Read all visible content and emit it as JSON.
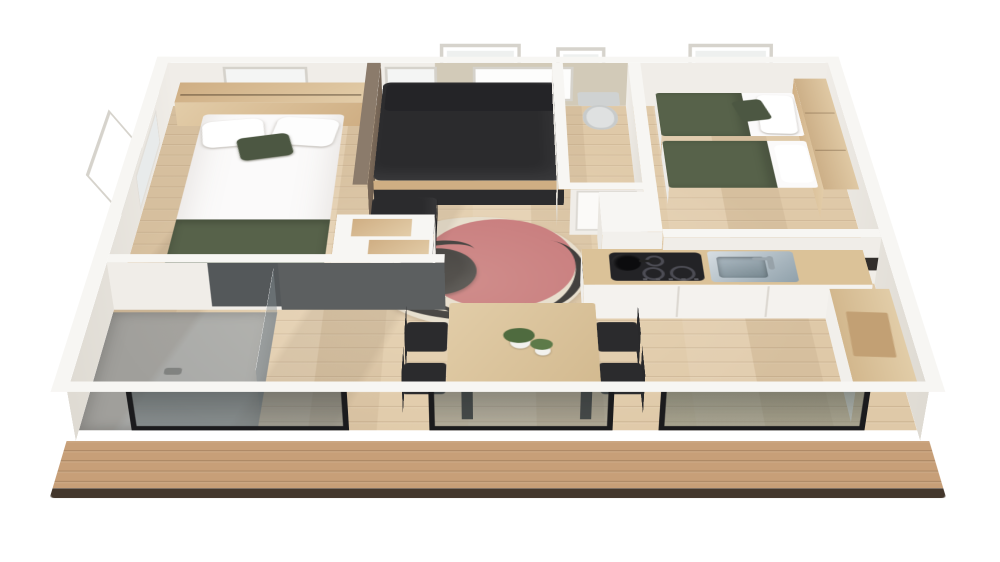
{
  "scene": {
    "type": "3d-floor-plan-render",
    "description": "isometric cutaway rendering of a mobile-home interior with front deck",
    "background": "#ffffff"
  },
  "palette": {
    "wall_top": "#f7f6f3",
    "wall_face": "#f0ede8",
    "wall_face_shade": "#dfdbd3",
    "accent_wall": "#7b6a5a",
    "accent_wall_light": "#8b7b6b",
    "living_back_wall": "#d2cab8",
    "floor_wood": "#dfc9a8",
    "deck_wood": "#c79f78",
    "deck_edge": "#43372c",
    "sofa_dark": "#2b2b2d",
    "wood_mid": "#cfae83",
    "bed_white": "#fbfafa",
    "olive": "#57624a",
    "olive_dark": "#4c5742",
    "rug_cream": "#e3dac9",
    "rug_red": "#c06a6e",
    "ink": "#1d1c1d",
    "counter_wood": "#dbc298",
    "cooktop": "#232326",
    "steel_light": "#d7dee3",
    "steel_dark": "#8fa0aa",
    "shower_floor": "#a8a9a7",
    "shower_panel": "#5c5f60",
    "glass_dark": "#545e60",
    "frame_black": "#1b1b1d",
    "toilet": "#dfe1e1",
    "plant": "#4f6b3f",
    "window_white": "#ffffff",
    "backsplash": "#322e2b"
  },
  "rooms": [
    {
      "name": "bedroom-left",
      "furniture": [
        "double-bed",
        "headboard-shelf",
        "wall-window",
        "storage-steps"
      ]
    },
    {
      "name": "living-area",
      "furniture": [
        "sofa",
        "ottoman",
        "round-rug",
        "round-coffee-table",
        "tilted-window"
      ]
    },
    {
      "name": "wc",
      "furniture": [
        "toilet",
        "tilted-window",
        "door"
      ]
    },
    {
      "name": "bedroom-right",
      "furniture": [
        "single-bed",
        "single-bed",
        "wardrobe-shelf",
        "tilted-window"
      ]
    },
    {
      "name": "kitchen",
      "furniture": [
        "cooktop",
        "pot",
        "sink",
        "counter",
        "tall-cabinet",
        "side-counter"
      ]
    },
    {
      "name": "bathroom",
      "furniture": [
        "shower",
        "glass-partition"
      ]
    },
    {
      "name": "dining-area",
      "furniture": [
        "dining-table",
        "chairs",
        "plants"
      ]
    },
    {
      "name": "deck",
      "furniture": []
    }
  ]
}
